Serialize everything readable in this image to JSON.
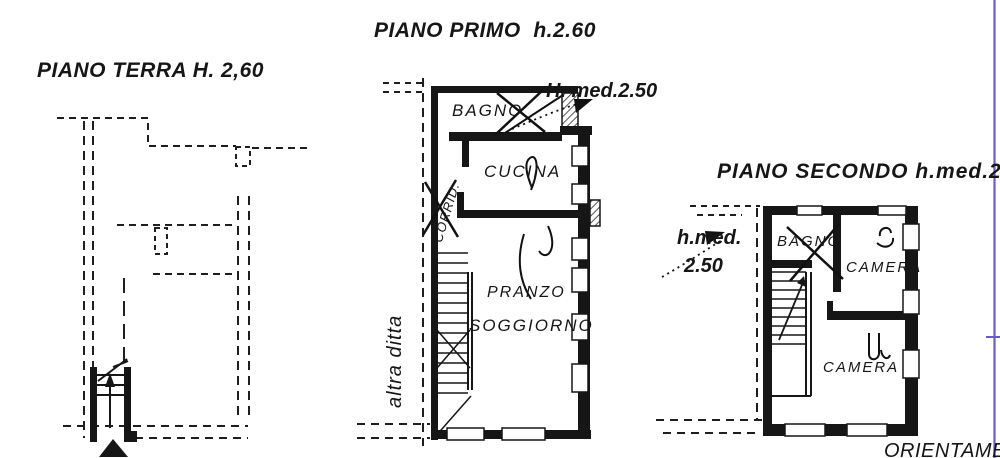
{
  "colors": {
    "ink": "#161616",
    "paper": "#ffffff",
    "fold_line": "#6a5acd"
  },
  "plans": {
    "terra": {
      "title": "PIANO TERRA H. 2,60"
    },
    "primo": {
      "title": "PIANO PRIMO  h.2.60",
      "height_note": "H. med.2.50",
      "side_label": "altra ditta",
      "rooms": {
        "bagno": "BAGNO",
        "corridoio": "CORRID.",
        "cucina": "CUCINA",
        "pranzo": "PRANZO",
        "soggiorno": "SOGGIORNO"
      }
    },
    "secondo": {
      "title": "PIANO SECONDO h.med.2",
      "height_note_line1": "h.med.",
      "height_note_line2": "2.50",
      "rooms": {
        "bagno": "BAGNO",
        "camera_1": "CAMERA",
        "camera_2": "CAMERA"
      }
    }
  },
  "footer": {
    "orientation_label": "ORIENTAMEN"
  }
}
